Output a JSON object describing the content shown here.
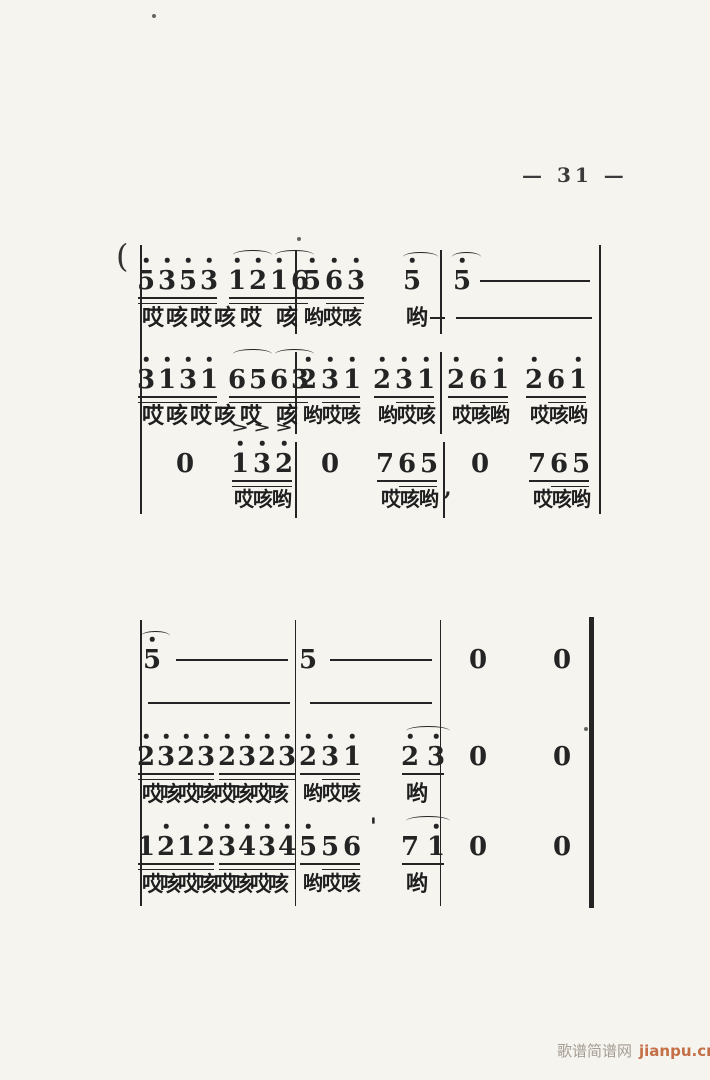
{
  "page": {
    "number_label": "— 31 —",
    "watermark": {
      "site_name": "歌谱简谱网",
      "site_url": "jianpu.cn"
    }
  },
  "colors": {
    "paper": "#f5f4ef",
    "ink": "#242424",
    "watermark_gray": "#a49d93",
    "watermark_orange": "#c46f45"
  },
  "specks": [
    {
      "x": 584,
      "y": 727
    },
    {
      "x": 152,
      "y": 14
    },
    {
      "x": 297,
      "y": 237
    }
  ],
  "systems": [
    {
      "brace": {
        "x": 116,
        "y": 240,
        "t": "("
      },
      "vlines": [
        {
          "x": 140,
          "y1": 245,
          "y2": 514,
          "w": 2
        },
        {
          "x": 599,
          "y1": 245,
          "y2": 514,
          "w": 1.8
        }
      ],
      "lines": [
        {
          "dy": 281,
          "ly": 306,
          "band": [
            250,
            334
          ],
          "bars": [
            295,
            440
          ],
          "groups": [
            {
              "x": 146,
              "dx": 21,
              "notes": [
                {
                  "d": "5",
                  "dot": 1
                },
                {
                  "d": "3",
                  "dot": 1
                },
                {
                  "d": "5",
                  "dot": 1
                },
                {
                  "d": "3",
                  "dot": 1
                }
              ],
              "uls": [
                [
                  0,
                  3
                ],
                [
                  0,
                  3
                ]
              ]
            },
            {
              "x": 237,
              "dx": 21,
              "notes": [
                {
                  "d": "1",
                  "dot": 1
                },
                {
                  "d": "2",
                  "dot": 1
                },
                {
                  "d": "1",
                  "dot": 1
                },
                {
                  "d": "6"
                }
              ],
              "uls": [
                [
                  0,
                  3
                ],
                [
                  0,
                  3
                ]
              ],
              "arcs": [
                [
                  0,
                  1
                ],
                [
                  2,
                  3
                ]
              ]
            },
            {
              "x": 312,
              "dx": 22,
              "notes": [
                {
                  "d": "5",
                  "dot": 1
                },
                {
                  "d": "6",
                  "dot": 1
                },
                {
                  "d": "3",
                  "dot": 1
                }
              ],
              "uls": [
                [
                  0,
                  2
                ],
                [
                  1,
                  2
                ]
              ]
            },
            {
              "x": 412,
              "notes": [
                {
                  "d": "5",
                  "dot": 1
                }
              ]
            },
            {
              "x": 462,
              "notes": [
                {
                  "d": "5",
                  "dot": 1
                }
              ]
            }
          ],
          "arcs_abs": [
            {
              "x1": 403,
              "x2": 438,
              "y": 252
            },
            {
              "x1": 452,
              "x2": 481,
              "y": 252
            }
          ],
          "dashes": [
            [
              480,
              590
            ]
          ],
          "lyrics": [
            {
              "x": 142,
              "t": "哎咳哎咳",
              "fs": 22,
              "ls": 2
            },
            {
              "x": 240,
              "t": "哎",
              "fs": 22
            },
            {
              "x": 276,
              "t": "咳",
              "fs": 22
            },
            {
              "x": 304,
              "t": "哟哎咳",
              "fs": 20,
              "ls": -1
            },
            {
              "x": 406,
              "t": "哟",
              "fs": 22
            }
          ],
          "lyric_dashes": [
            [
              430,
              445
            ],
            [
              456,
              592
            ]
          ]
        },
        {
          "dy": 380,
          "ly": 404,
          "band": [
            352,
            434
          ],
          "bars": [
            295,
            440
          ],
          "groups": [
            {
              "x": 146,
              "dx": 21,
              "notes": [
                {
                  "d": "3",
                  "dot": 1
                },
                {
                  "d": "1",
                  "dot": 1
                },
                {
                  "d": "3",
                  "dot": 1
                },
                {
                  "d": "1",
                  "dot": 1
                }
              ],
              "uls": [
                [
                  0,
                  3
                ],
                [
                  0,
                  3
                ]
              ]
            },
            {
              "x": 237,
              "dx": 21,
              "notes": [
                {
                  "d": "6"
                },
                {
                  "d": "5"
                },
                {
                  "d": "6"
                },
                {
                  "d": "3"
                }
              ],
              "uls": [
                [
                  0,
                  3
                ],
                [
                  0,
                  3
                ]
              ],
              "arcs": [
                [
                  0,
                  1
                ],
                [
                  2,
                  3
                ]
              ]
            },
            {
              "x": 308,
              "dx": 22,
              "notes": [
                {
                  "d": "2",
                  "dot": 1
                },
                {
                  "d": "3",
                  "dot": 1
                },
                {
                  "d": "1",
                  "dot": 1
                }
              ],
              "uls": [
                [
                  0,
                  2
                ],
                [
                  1,
                  2
                ]
              ]
            },
            {
              "x": 382,
              "dx": 22,
              "notes": [
                {
                  "d": "2",
                  "dot": 1
                },
                {
                  "d": "3",
                  "dot": 1
                },
                {
                  "d": "1",
                  "dot": 1
                }
              ],
              "uls": [
                [
                  0,
                  2
                ],
                [
                  1,
                  2
                ]
              ]
            },
            {
              "x": 456,
              "dx": 22,
              "notes": [
                {
                  "d": "2",
                  "dot": 1
                },
                {
                  "d": "6"
                },
                {
                  "d": "1",
                  "dot": 1
                }
              ],
              "uls": [
                [
                  0,
                  2
                ],
                [
                  1,
                  2
                ]
              ]
            },
            {
              "x": 534,
              "dx": 22,
              "notes": [
                {
                  "d": "2",
                  "dot": 1
                },
                {
                  "d": "6"
                },
                {
                  "d": "1",
                  "dot": 1
                }
              ],
              "uls": [
                [
                  0,
                  2
                ],
                [
                  1,
                  2
                ]
              ]
            }
          ],
          "lyrics": [
            {
              "x": 142,
              "t": "哎咳哎咳",
              "fs": 22,
              "ls": 2
            },
            {
              "x": 240,
              "t": "哎",
              "fs": 22
            },
            {
              "x": 276,
              "t": "咳",
              "fs": 22
            },
            {
              "x": 303,
              "t": "哟哎咳",
              "fs": 20,
              "ls": -1
            },
            {
              "x": 378,
              "t": "哟哎咳",
              "fs": 20,
              "ls": -1
            },
            {
              "x": 452,
              "t": "哎咳哟",
              "fs": 20,
              "ls": -1
            },
            {
              "x": 530,
              "t": "哎咳哟",
              "fs": 20,
              "ls": -1
            }
          ]
        },
        {
          "dy": 464,
          "ly": 488,
          "band": [
            442,
            518
          ],
          "bars": [
            295,
            443
          ],
          "groups": [
            {
              "x": 240,
              "dx": 22,
              "notes": [
                {
                  "d": "1",
                  "dot": 1
                },
                {
                  "d": "3",
                  "dot": 1
                },
                {
                  "d": "2",
                  "dot": 1
                }
              ],
              "uls": [
                [
                  0,
                  2
                ],
                [
                  0,
                  2
                ]
              ],
              "accents": [
                0,
                1,
                2
              ]
            },
            {
              "x": 385,
              "dx": 22,
              "notes": [
                {
                  "d": "7"
                },
                {
                  "d": "6"
                },
                {
                  "d": "5"
                }
              ],
              "uls": [
                [
                  0,
                  2
                ],
                [
                  1,
                  2
                ]
              ]
            },
            {
              "x": 537,
              "dx": 22,
              "notes": [
                {
                  "d": "7"
                },
                {
                  "d": "6"
                },
                {
                  "d": "5"
                }
              ],
              "uls": [
                [
                  0,
                  2
                ],
                [
                  1,
                  2
                ]
              ]
            }
          ],
          "rests": [
            {
              "x": 185
            },
            {
              "x": 330
            },
            {
              "x": 480
            }
          ],
          "marks": [
            {
              "x": 444,
              "y": 477,
              "t": ","
            }
          ],
          "lyrics": [
            {
              "x": 234,
              "t": "哎咳哟",
              "fs": 20,
              "ls": -1
            },
            {
              "x": 381,
              "t": "哎咳哟",
              "fs": 20,
              "ls": -1
            },
            {
              "x": 533,
              "t": "哎咳哟",
              "fs": 20,
              "ls": -1
            }
          ]
        }
      ]
    },
    {
      "vlines": [
        {
          "x": 140,
          "y1": 620,
          "y2": 906,
          "w": 2
        },
        {
          "x": 295,
          "y1": 620,
          "y2": 906,
          "w": 1.4
        },
        {
          "x": 440,
          "y1": 620,
          "y2": 906,
          "w": 1.4
        },
        {
          "x": 589,
          "y1": 617,
          "y2": 908,
          "w": 5
        }
      ],
      "lines": [
        {
          "dy": 660,
          "ly": 691,
          "groups": [
            {
              "x": 152,
              "notes": [
                {
                  "d": "5",
                  "dot": 1
                }
              ]
            },
            {
              "x": 308,
              "notes": [
                {
                  "d": "5"
                }
              ]
            }
          ],
          "arcs_abs": [
            {
              "x1": 141,
              "x2": 170,
              "y": 631
            }
          ],
          "dashes": [
            [
              176,
              288
            ],
            [
              330,
              432
            ]
          ],
          "rests": [
            {
              "x": 478
            },
            {
              "x": 562
            }
          ],
          "lyric_dashes": [
            [
              148,
              290
            ],
            [
              310,
              432
            ]
          ]
        },
        {
          "dy": 757,
          "ly": 782,
          "groups": [
            {
              "x": 146,
              "dx": 20,
              "notes": [
                {
                  "d": "2",
                  "dot": 1
                },
                {
                  "d": "3",
                  "dot": 1
                },
                {
                  "d": "2",
                  "dot": 1
                },
                {
                  "d": "3",
                  "dot": 1
                }
              ],
              "uls": [
                [
                  0,
                  3
                ],
                [
                  0,
                  3
                ]
              ]
            },
            {
              "x": 227,
              "dx": 20,
              "notes": [
                {
                  "d": "2",
                  "dot": 1
                },
                {
                  "d": "3",
                  "dot": 1
                },
                {
                  "d": "2",
                  "dot": 1
                },
                {
                  "d": "3",
                  "dot": 1
                }
              ],
              "uls": [
                [
                  0,
                  3
                ],
                [
                  0,
                  3
                ]
              ]
            },
            {
              "x": 308,
              "dx": 22,
              "notes": [
                {
                  "d": "2",
                  "dot": 1
                },
                {
                  "d": "3",
                  "dot": 1
                },
                {
                  "d": "1",
                  "dot": 1
                }
              ],
              "uls": [
                [
                  0,
                  2
                ],
                [
                  1,
                  2
                ]
              ]
            },
            {
              "x": 410,
              "dx": 26,
              "notes": [
                {
                  "d": "2",
                  "dot": 1
                },
                {
                  "d": "3",
                  "dot": 1
                }
              ],
              "uls": [
                [
                  0,
                  1
                ]
              ],
              "arcs": [
                [
                  0,
                  1
                ]
              ]
            }
          ],
          "rests": [
            {
              "x": 478
            },
            {
              "x": 562
            }
          ],
          "lyrics": [
            {
              "x": 142,
              "t": "哎咳哎咳哎咳哎咳",
              "fs": 21,
              "ls": -3
            },
            {
              "x": 303,
              "t": "哟哎咳",
              "fs": 20,
              "ls": -1
            },
            {
              "x": 406,
              "t": "哟",
              "fs": 22
            }
          ]
        },
        {
          "dy": 847,
          "ly": 872,
          "groups": [
            {
              "x": 146,
              "dx": 20,
              "notes": [
                {
                  "d": "1"
                },
                {
                  "d": "2",
                  "dot": 1
                },
                {
                  "d": "1"
                },
                {
                  "d": "2",
                  "dot": 1
                }
              ],
              "uls": [
                [
                  0,
                  3
                ],
                [
                  0,
                  3
                ]
              ]
            },
            {
              "x": 227,
              "dx": 20,
              "notes": [
                {
                  "d": "3",
                  "dot": 1
                },
                {
                  "d": "4",
                  "dot": 1
                },
                {
                  "d": "3",
                  "dot": 1
                },
                {
                  "d": "4",
                  "dot": 1
                }
              ],
              "uls": [
                [
                  0,
                  3
                ],
                [
                  0,
                  3
                ]
              ]
            },
            {
              "x": 308,
              "dx": 22,
              "notes": [
                {
                  "d": "5",
                  "dot": 1
                },
                {
                  "d": "5"
                },
                {
                  "d": "6"
                }
              ],
              "uls": [
                [
                  0,
                  2
                ],
                [
                  1,
                  2
                ]
              ]
            },
            {
              "x": 410,
              "dx": 26,
              "notes": [
                {
                  "d": "7"
                },
                {
                  "d": "1",
                  "dot": 1
                }
              ],
              "uls": [
                [
                  0,
                  1
                ]
              ],
              "arcs": [
                [
                  0,
                  1
                ]
              ]
            }
          ],
          "rests": [
            {
              "x": 478
            },
            {
              "x": 562
            }
          ],
          "marks": [
            {
              "x": 370,
              "y": 816,
              "t": "'"
            }
          ],
          "lyrics": [
            {
              "x": 142,
              "t": "哎咳哎咳哎咳哎咳",
              "fs": 21,
              "ls": -3
            },
            {
              "x": 303,
              "t": "哟哎咳",
              "fs": 20,
              "ls": -1
            },
            {
              "x": 406,
              "t": "哟",
              "fs": 22
            }
          ]
        }
      ]
    }
  ]
}
